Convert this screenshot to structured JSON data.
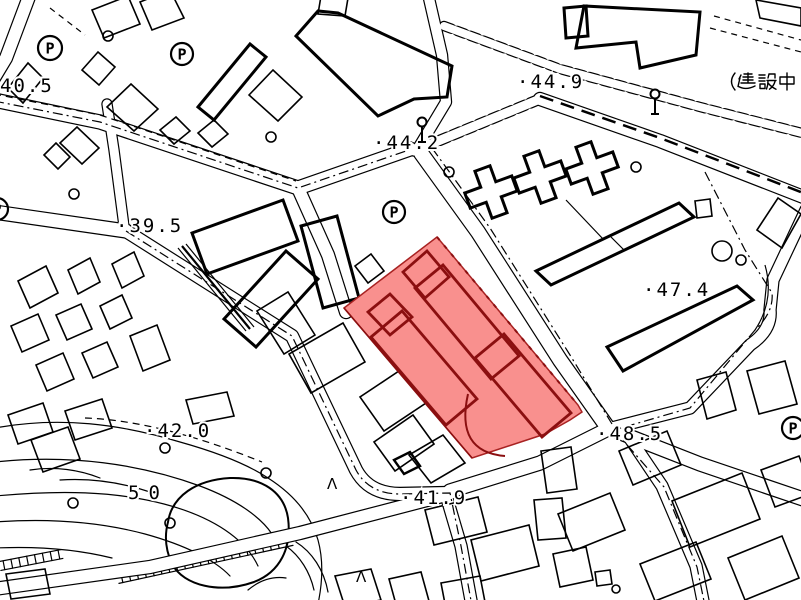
{
  "map": {
    "background": "#ffffff",
    "ink": "#000000",
    "highlight": {
      "label": "selected-parcel",
      "fill": "#f9908e",
      "building_line": "#8b0f10",
      "edge_line": "#a82222"
    },
    "spot_elevations": [
      {
        "text": "40.5",
        "x": 0,
        "y": 92
      },
      {
        "text": "·39.5",
        "x": 116,
        "y": 232
      },
      {
        "text": "·44.2",
        "x": 373,
        "y": 149
      },
      {
        "text": "·44.9",
        "x": 517,
        "y": 88
      },
      {
        "text": "·47.4",
        "x": 643,
        "y": 296
      },
      {
        "text": "·42.0",
        "x": 144,
        "y": 437
      },
      {
        "text": "·41.9",
        "x": 400,
        "y": 504
      },
      {
        "text": "·48.5",
        "x": 596,
        "y": 440
      }
    ],
    "contour_labels": [
      {
        "text": "50",
        "x": 128,
        "y": 499,
        "spacing": 9
      }
    ],
    "annotations": [
      {
        "text": "（建設中",
        "x": 728,
        "y": 90
      }
    ],
    "symbols": {
      "parking_glyph": "P",
      "parking": [
        {
          "x": 50,
          "y": 48,
          "r": 12
        },
        {
          "x": 182,
          "y": 54,
          "r": 11
        },
        {
          "x": 394,
          "y": 212,
          "r": 11
        },
        {
          "x": 793,
          "y": 428,
          "r": 11
        },
        {
          "x": -3,
          "y": 209,
          "r": 11
        }
      ],
      "streetlights": [
        {
          "x": 422,
          "y": 122
        },
        {
          "x": 655,
          "y": 94
        }
      ],
      "small_circles": [
        {
          "x": 108,
          "y": 36,
          "r": 5
        },
        {
          "x": 271,
          "y": 137,
          "r": 5
        },
        {
          "x": 449,
          "y": 172,
          "r": 5
        },
        {
          "x": 636,
          "y": 167,
          "r": 5
        },
        {
          "x": 74,
          "y": 194,
          "r": 5
        },
        {
          "x": 722,
          "y": 251,
          "r": 10
        },
        {
          "x": 741,
          "y": 260,
          "r": 5
        },
        {
          "x": 616,
          "y": 589,
          "r": 4
        },
        {
          "x": 73,
          "y": 503,
          "r": 5
        },
        {
          "x": 165,
          "y": 448,
          "r": 5
        },
        {
          "x": 170,
          "y": 523,
          "r": 5
        },
        {
          "x": 266,
          "y": 473,
          "r": 5
        }
      ],
      "slope_mark_glyph": "Λ",
      "slope_marks": [
        {
          "x": 327,
          "y": 489
        },
        {
          "x": 356,
          "y": 582
        }
      ]
    }
  }
}
